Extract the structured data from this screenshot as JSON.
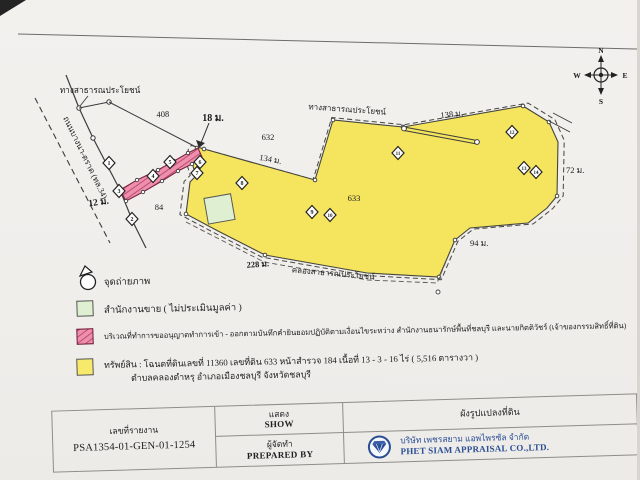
{
  "doc": {
    "type_note": "scanned land plot layout page",
    "colors": {
      "parcel_yellow": "#f5e55e",
      "access_pink": "#ee8fae",
      "office_green": "#dff0d2",
      "brand_navy": "#2a4d94"
    }
  },
  "map": {
    "labels": {
      "road_top_left": "ทางสาธารณประโยชน์",
      "road_top": "ทางสาธารณประโยชน์",
      "canal_bottom": "คลองสาธารณประโยชน์",
      "road_bangna_trad": "ถนนบางนา-ตราด (ทล.34)",
      "dim_408": "408",
      "dim_18m": "18 ม.",
      "dim_632": "632",
      "dim_134m": "134 ม.",
      "dim_138m": "138 ม.",
      "dim_72m": "72 ม.",
      "dim_94m": "94 ม.",
      "dim_228m": "228 ม.",
      "dim_633": "633",
      "dim_84": "84",
      "dim_12m": "12 ม."
    },
    "compass": {
      "n": "N",
      "e": "E",
      "s": "S",
      "w": "W"
    },
    "markers": [
      "1",
      "2",
      "3",
      "4",
      "5",
      "6",
      "7",
      "8",
      "9",
      "10",
      "11",
      "12",
      "13",
      "14"
    ]
  },
  "legend": {
    "photo_point": "จุดถ่ายภาพ",
    "sales_office": "สำนักงานขาย ( ไม่ประเมินมูลค่า )",
    "pink_area": "บริเวณที่ทำการขออนุญาตทำการเข้า - ออกตามบันทึกคำยินยอมปฏิบัติตามเงื่อนไขระหว่าง สำนักงานธนารักษ์พื้นที่ชลบุรี และนายกิตติวัชร์ (เจ้าของกรรมสิทธิ์ที่ดิน)",
    "property_line1": "ทรัพย์สิน : โฉนดที่ดินเลขที่ 11360 เลขที่ดิน 633 หน้าสำรวจ 184 เนื้อที่ 13 - 3 - 16 ไร่ ( 5,516 ตารางวา )",
    "property_line2": "ตำบลคลองตำหรุ อำเภอเมืองชลบุรี จังหวัดชลบุรี"
  },
  "table": {
    "report_no_label": "เลขที่รายงาน",
    "report_no_value": "PSA1354-01-GEN-01-1254",
    "show_th": "แสดง",
    "show_en": "SHOW",
    "prepared_th": "ผู้จัดทำ",
    "prepared_en": "PREPARED BY",
    "diagram_title": "ผังรูปแปลงที่ดิน",
    "company_th": "บริษัท เพชรสยาม แอพไพรซัล จำกัด",
    "company_en": "PHET SIAM APPRAISAL CO.,LTD."
  }
}
